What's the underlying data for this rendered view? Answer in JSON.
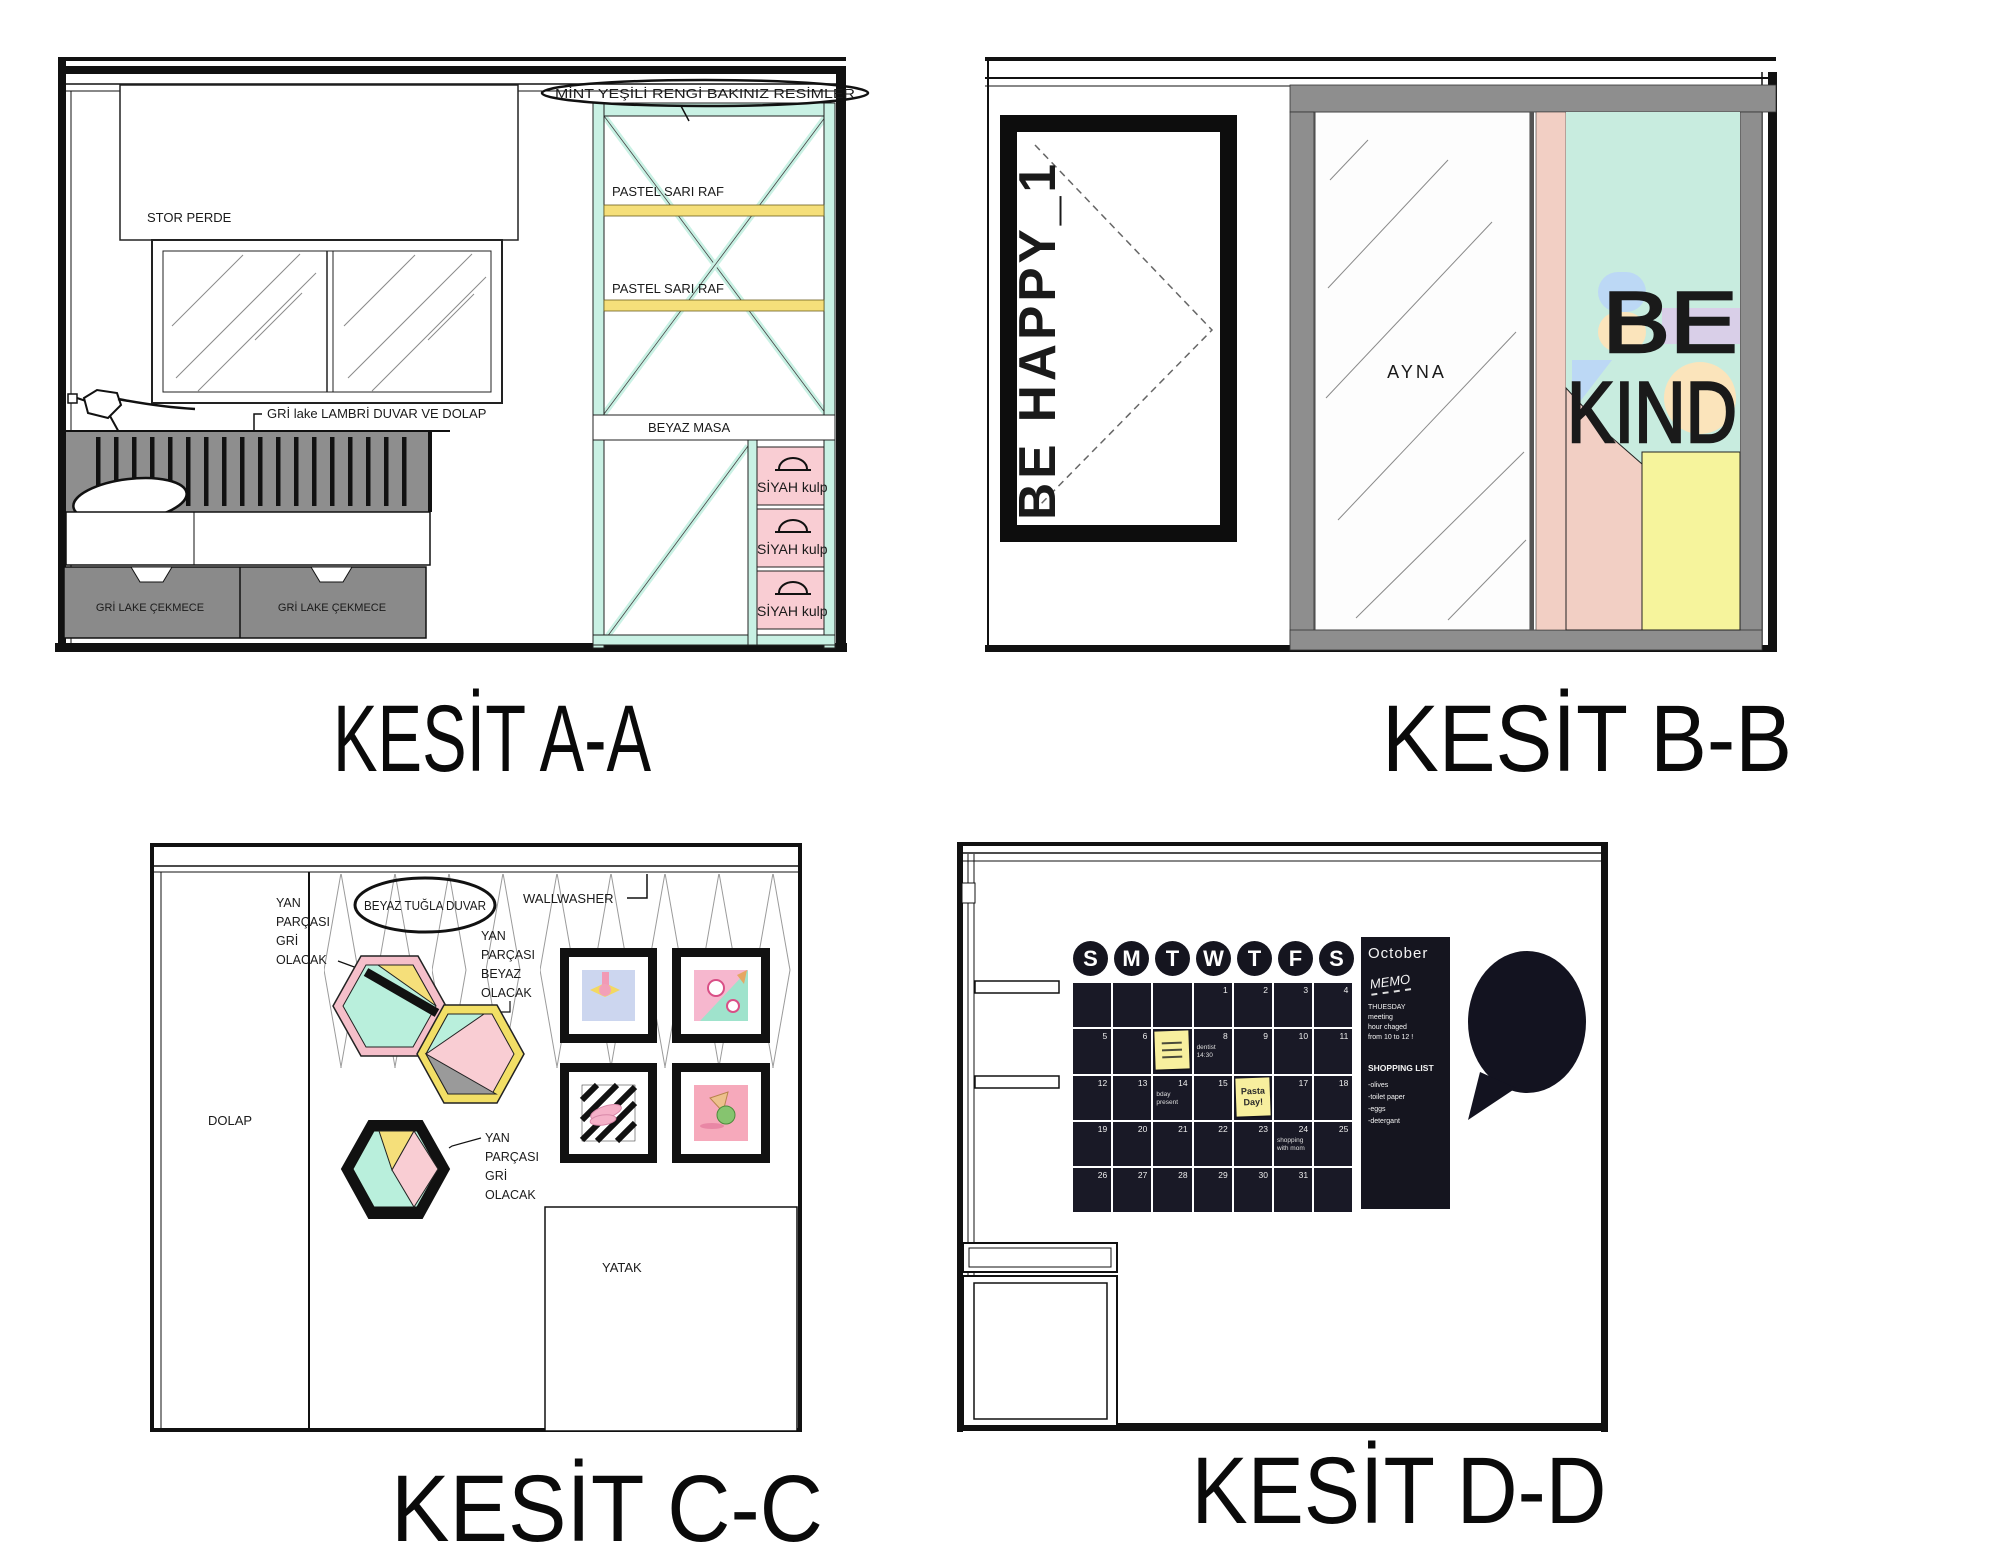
{
  "colors": {
    "mint": "#c9f1e4",
    "pastel_yellow": "#f5df7a",
    "pastel_pink": "#f9cdd3",
    "panel_gray": "#8e8e8e",
    "board_dark": "#15151f",
    "sticky_yellow": "#f7ef9e",
    "art_mint": "#c8ecdf",
    "art_pink": "#f2cfc4",
    "art_yellow": "#f6f49c",
    "art_blue": "#bcd8f5",
    "art_lavender": "#d9cfe8",
    "art_peach": "#fbe4bb"
  },
  "aa": {
    "title": "KESİT A-A",
    "stor_perde": "STOR PERDE",
    "lambri_note": "GRİ lake LAMBRİ DUVAR VE DOLAP",
    "cekmece_1": "GRİ LAKE ÇEKMECE",
    "cekmece_2": "GRİ LAKE ÇEKMECE",
    "raf_1": "PASTEL SARI RAF",
    "raf_2": "PASTEL SARI RAF",
    "masa": "BEYAZ MASA",
    "kulp_1": "SİYAH kulp",
    "kulp_2": "SİYAH kulp",
    "kulp_3": "SİYAH kulp",
    "mint_note": "MİNT YEŞİLİ RENGİ BAKINIZ RESİMLER"
  },
  "bb": {
    "title": "KESİT B-B",
    "door_text": "BE HAPPY_1",
    "ayna": "AYNA",
    "art_word_1": "BE",
    "art_word_2": "KIND"
  },
  "cc": {
    "title": "KESİT C-C",
    "ellipse_note": "BEYAZ TUĞLA DUVAR",
    "wallwasher": "WALLWASHER",
    "label_gray_1": [
      "YAN",
      "PARÇASI",
      "GRİ",
      "OLACAK"
    ],
    "label_white": [
      "YAN",
      "PARÇASI",
      "BEYAZ",
      "OLACAK"
    ],
    "label_gray_2": [
      "YAN",
      "PARÇASI",
      "GRİ",
      "OLACAK"
    ],
    "dolap": "DOLAP",
    "yatak": "YATAK"
  },
  "dd": {
    "title": "KESİT D-D",
    "month": "October",
    "memo_title": "MEMO",
    "memo_lines": [
      "THUESDAY",
      "meeting",
      "hour chaged",
      "from 10 to 12 !"
    ],
    "list_title": "SHOPPING LIST",
    "list_items": [
      "-olives",
      "-toilet paper",
      "-eggs",
      "-detergant"
    ],
    "day_headers": [
      "S",
      "M",
      "T",
      "W",
      "T",
      "F",
      "S"
    ],
    "sticky_pasta": [
      "Pasta",
      "Day!"
    ],
    "cells": [
      {
        "day": ""
      },
      {
        "day": ""
      },
      {
        "day": ""
      },
      {
        "day": "1"
      },
      {
        "day": "2"
      },
      {
        "day": "3"
      },
      {
        "day": "4"
      },
      {
        "day": "5"
      },
      {
        "day": "6"
      },
      {
        "day": ""
      },
      {
        "day": "8",
        "n1": "dentist",
        "n2": "14:30"
      },
      {
        "day": "9"
      },
      {
        "day": "10"
      },
      {
        "day": "11"
      },
      {
        "day": "12"
      },
      {
        "day": "13"
      },
      {
        "day": "14",
        "n1": "bday",
        "n2": "present"
      },
      {
        "day": "15"
      },
      {
        "day": ""
      },
      {
        "day": "17"
      },
      {
        "day": "18"
      },
      {
        "day": "19"
      },
      {
        "day": "20"
      },
      {
        "day": "21"
      },
      {
        "day": "22"
      },
      {
        "day": "23"
      },
      {
        "day": "24",
        "n1": "shopping",
        "n2": "with mom"
      },
      {
        "day": "25"
      },
      {
        "day": "26"
      },
      {
        "day": "27"
      },
      {
        "day": "28"
      },
      {
        "day": "29"
      },
      {
        "day": "30"
      },
      {
        "day": "31"
      },
      {
        "day": ""
      }
    ]
  }
}
